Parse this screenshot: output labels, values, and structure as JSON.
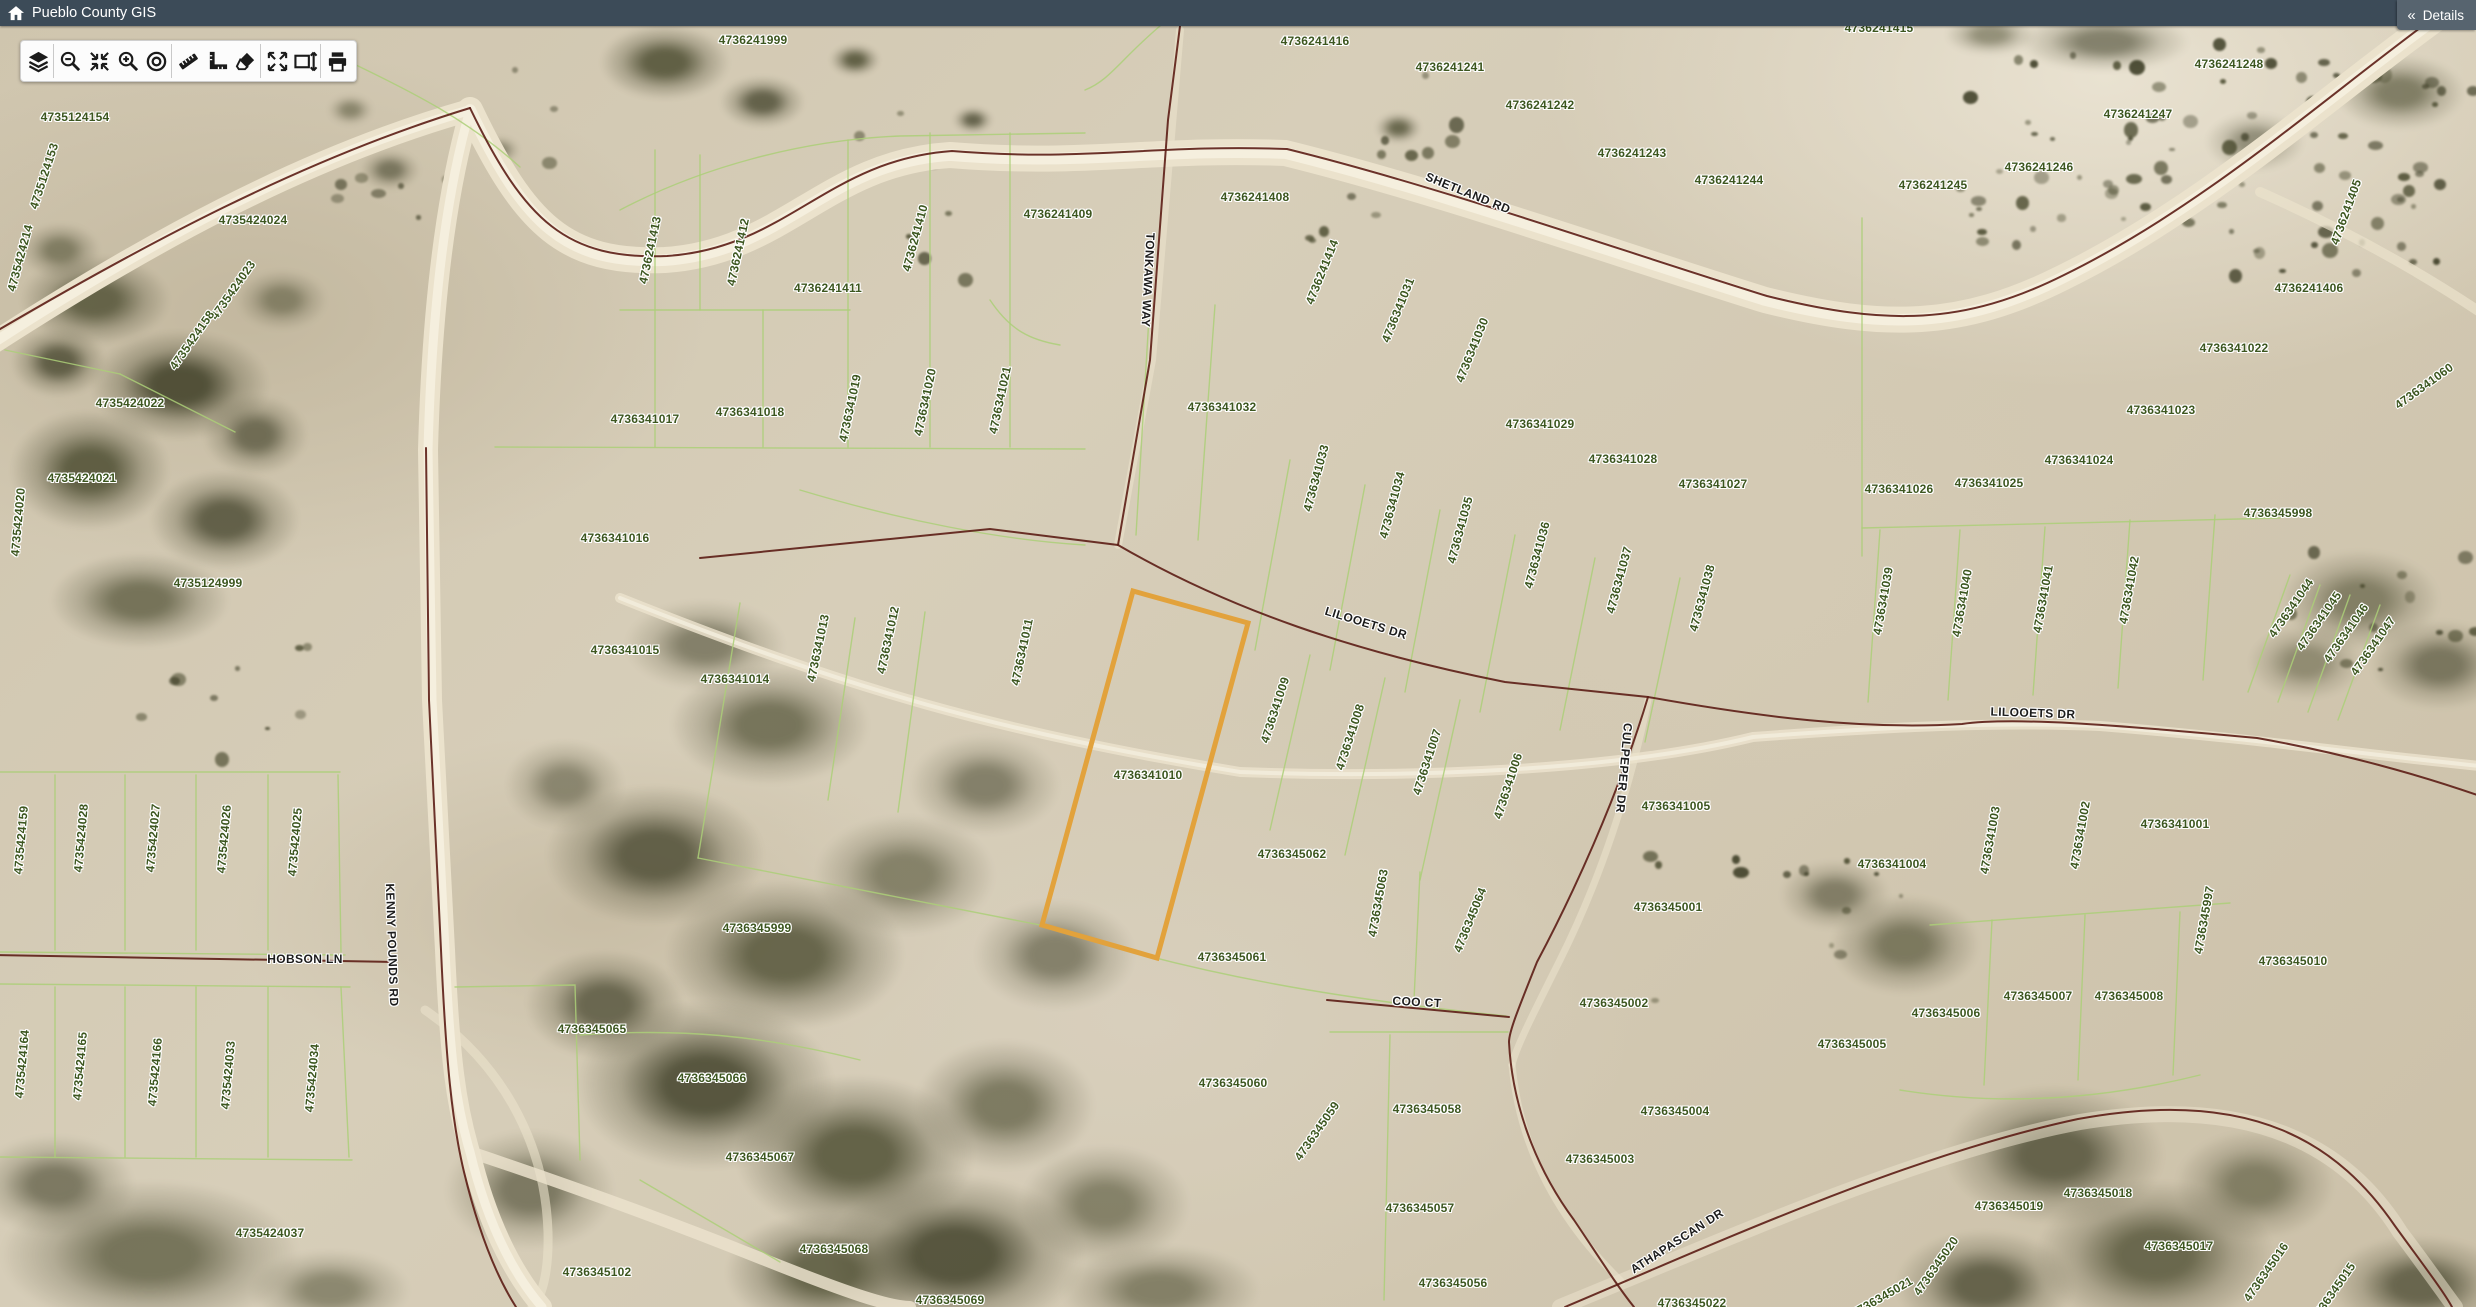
{
  "header": {
    "title": "Pueblo County GIS"
  },
  "details_panel": {
    "label": "Details",
    "collapse_icon": "«"
  },
  "toolbar": {
    "tools": [
      {
        "name": "layers",
        "icon": "layers-icon",
        "group_end": true
      },
      {
        "name": "zoom-out",
        "icon": "zoom-out-icon",
        "group_end": false
      },
      {
        "name": "zoom-to-extent",
        "icon": "zoom-extent-icon",
        "group_end": false
      },
      {
        "name": "zoom-in",
        "icon": "zoom-in-icon",
        "group_end": false
      },
      {
        "name": "locate",
        "icon": "locate-icon",
        "group_end": true
      },
      {
        "name": "measure-distance",
        "icon": "measure-distance-icon",
        "group_end": false
      },
      {
        "name": "measure-area",
        "icon": "measure-area-icon",
        "group_end": false
      },
      {
        "name": "erase",
        "icon": "eraser-icon",
        "group_end": true
      },
      {
        "name": "full-extent",
        "icon": "expand-arrows-icon",
        "group_end": false
      },
      {
        "name": "select-extent",
        "icon": "extent-box-icon",
        "group_end": true
      },
      {
        "name": "print",
        "icon": "printer-icon",
        "group_end": false
      }
    ]
  },
  "map": {
    "colors": {
      "parcel_label": "#3c561f",
      "road_label": "#1c1c1c",
      "parcel_line": "#accf78",
      "boundary_line": "#5c1d15",
      "highlight": "#e2a23c"
    },
    "highlighted_parcel": {
      "parcel_id": "4736341010",
      "outline_color": "#e2a23c",
      "points": "1133,591 1248,623 1157,958 1042,925"
    },
    "parcel_labels": [
      {
        "t": "4735124154",
        "x": 75,
        "y": 117,
        "r": 0
      },
      {
        "t": "4735124153",
        "x": 44,
        "y": 176,
        "r": -72
      },
      {
        "t": "4735424214",
        "x": 20,
        "y": 258,
        "r": -75
      },
      {
        "t": "4735424024",
        "x": 253,
        "y": 220,
        "r": 0
      },
      {
        "t": "4735424023",
        "x": 233,
        "y": 290,
        "r": -55
      },
      {
        "t": "4735424158",
        "x": 192,
        "y": 340,
        "r": -55
      },
      {
        "t": "4735424022",
        "x": 130,
        "y": 403,
        "r": 0
      },
      {
        "t": "4735424021",
        "x": 82,
        "y": 478,
        "r": 0
      },
      {
        "t": "4735424020",
        "x": 18,
        "y": 522,
        "r": -85
      },
      {
        "t": "4735124999",
        "x": 208,
        "y": 583,
        "r": 0
      },
      {
        "t": "4735424159",
        "x": 21,
        "y": 840,
        "r": -85
      },
      {
        "t": "4735424028",
        "x": 81,
        "y": 838,
        "r": -85
      },
      {
        "t": "4735424027",
        "x": 153,
        "y": 838,
        "r": -85
      },
      {
        "t": "4735424026",
        "x": 224,
        "y": 839,
        "r": -85
      },
      {
        "t": "4735424025",
        "x": 295,
        "y": 842,
        "r": -85
      },
      {
        "t": "4735424164",
        "x": 22,
        "y": 1064,
        "r": -85
      },
      {
        "t": "4735424165",
        "x": 80,
        "y": 1066,
        "r": -85
      },
      {
        "t": "4735424166",
        "x": 155,
        "y": 1072,
        "r": -85
      },
      {
        "t": "4735424033",
        "x": 228,
        "y": 1075,
        "r": -85
      },
      {
        "t": "4735424034",
        "x": 312,
        "y": 1078,
        "r": -85
      },
      {
        "t": "4735424037",
        "x": 270,
        "y": 1233,
        "r": 0
      },
      {
        "t": "4736241999",
        "x": 753,
        "y": 40,
        "r": 0
      },
      {
        "t": "4736241400",
        "x": 1065,
        "y": 14,
        "r": 0
      },
      {
        "t": "4736241413",
        "x": 650,
        "y": 250,
        "r": -78
      },
      {
        "t": "4736241412",
        "x": 738,
        "y": 252,
        "r": -78
      },
      {
        "t": "4736241411",
        "x": 828,
        "y": 288,
        "r": 0
      },
      {
        "t": "4736241410",
        "x": 915,
        "y": 238,
        "r": -75
      },
      {
        "t": "4736241409",
        "x": 1058,
        "y": 214,
        "r": 0
      },
      {
        "t": "4736241408",
        "x": 1255,
        "y": 197,
        "r": 0
      },
      {
        "t": "4736241416",
        "x": 1315,
        "y": 41,
        "r": 0
      },
      {
        "t": "4736241241",
        "x": 1450,
        "y": 67,
        "r": 0
      },
      {
        "t": "4736241242",
        "x": 1540,
        "y": 105,
        "r": 0
      },
      {
        "t": "4736241243",
        "x": 1632,
        "y": 153,
        "r": 0
      },
      {
        "t": "4736241244",
        "x": 1729,
        "y": 180,
        "r": 0
      },
      {
        "t": "4736241245",
        "x": 1933,
        "y": 185,
        "r": 0
      },
      {
        "t": "4736241246",
        "x": 2039,
        "y": 167,
        "r": 0
      },
      {
        "t": "4736241247",
        "x": 2138,
        "y": 114,
        "r": 0
      },
      {
        "t": "4736241248",
        "x": 2229,
        "y": 64,
        "r": 0
      },
      {
        "t": "4736241415",
        "x": 1879,
        "y": 28,
        "r": 0
      },
      {
        "t": "4736241414",
        "x": 1322,
        "y": 272,
        "r": -68
      },
      {
        "t": "4736341031",
        "x": 1398,
        "y": 310,
        "r": -68
      },
      {
        "t": "4736341030",
        "x": 1472,
        "y": 350,
        "r": -68
      },
      {
        "t": "4736241405",
        "x": 2346,
        "y": 212,
        "r": -70
      },
      {
        "t": "4736241406",
        "x": 2309,
        "y": 288,
        "r": 0
      },
      {
        "t": "4736341060",
        "x": 2424,
        "y": 386,
        "r": -36
      },
      {
        "t": "4736341022",
        "x": 2234,
        "y": 348,
        "r": 0
      },
      {
        "t": "4736341023",
        "x": 2161,
        "y": 410,
        "r": 0
      },
      {
        "t": "4736341024",
        "x": 2079,
        "y": 460,
        "r": 0
      },
      {
        "t": "4736341025",
        "x": 1989,
        "y": 483,
        "r": 0
      },
      {
        "t": "4736341026",
        "x": 1899,
        "y": 489,
        "r": 0
      },
      {
        "t": "4736345998",
        "x": 2278,
        "y": 513,
        "r": 0
      },
      {
        "t": "4736341017",
        "x": 645,
        "y": 419,
        "r": 0
      },
      {
        "t": "4736341018",
        "x": 750,
        "y": 412,
        "r": 0
      },
      {
        "t": "4736341019",
        "x": 850,
        "y": 408,
        "r": -78
      },
      {
        "t": "4736341020",
        "x": 925,
        "y": 402,
        "r": -78
      },
      {
        "t": "4736341021",
        "x": 1000,
        "y": 400,
        "r": -78
      },
      {
        "t": "4736341032",
        "x": 1222,
        "y": 407,
        "r": 0
      },
      {
        "t": "4736341033",
        "x": 1316,
        "y": 478,
        "r": -75
      },
      {
        "t": "4736341034",
        "x": 1392,
        "y": 505,
        "r": -75
      },
      {
        "t": "4736341035",
        "x": 1460,
        "y": 530,
        "r": -75
      },
      {
        "t": "4736341036",
        "x": 1537,
        "y": 555,
        "r": -75
      },
      {
        "t": "4736341037",
        "x": 1619,
        "y": 580,
        "r": -75
      },
      {
        "t": "4736341038",
        "x": 1702,
        "y": 598,
        "r": -75
      },
      {
        "t": "4736341029",
        "x": 1540,
        "y": 424,
        "r": 0
      },
      {
        "t": "4736341028",
        "x": 1623,
        "y": 459,
        "r": 0
      },
      {
        "t": "4736341027",
        "x": 1713,
        "y": 484,
        "r": 0
      },
      {
        "t": "4736341016",
        "x": 615,
        "y": 538,
        "r": 0
      },
      {
        "t": "4736341015",
        "x": 625,
        "y": 650,
        "r": 0
      },
      {
        "t": "4736341014",
        "x": 735,
        "y": 679,
        "r": 0
      },
      {
        "t": "4736341013",
        "x": 818,
        "y": 648,
        "r": -78
      },
      {
        "t": "4736341012",
        "x": 888,
        "y": 640,
        "r": -78
      },
      {
        "t": "4736341011",
        "x": 1022,
        "y": 652,
        "r": -78
      },
      {
        "t": "4736341010",
        "x": 1148,
        "y": 775,
        "r": 0
      },
      {
        "t": "4736341009",
        "x": 1275,
        "y": 710,
        "r": -72
      },
      {
        "t": "4736341008",
        "x": 1350,
        "y": 737,
        "r": -72
      },
      {
        "t": "4736341007",
        "x": 1427,
        "y": 762,
        "r": -72
      },
      {
        "t": "4736341006",
        "x": 1508,
        "y": 786,
        "r": -72
      },
      {
        "t": "4736341005",
        "x": 1676,
        "y": 806,
        "r": 0
      },
      {
        "t": "4736345062",
        "x": 1292,
        "y": 854,
        "r": 0
      },
      {
        "t": "4736341039",
        "x": 1883,
        "y": 601,
        "r": -80
      },
      {
        "t": "4736341040",
        "x": 1962,
        "y": 603,
        "r": -80
      },
      {
        "t": "4736341041",
        "x": 2043,
        "y": 599,
        "r": -80
      },
      {
        "t": "4736341042",
        "x": 2129,
        "y": 590,
        "r": -80
      },
      {
        "t": "4736341044",
        "x": 2291,
        "y": 608,
        "r": -55
      },
      {
        "t": "4736341045",
        "x": 2319,
        "y": 621,
        "r": -55
      },
      {
        "t": "4736341046",
        "x": 2346,
        "y": 633,
        "r": -55
      },
      {
        "t": "4736341047",
        "x": 2373,
        "y": 646,
        "r": -55
      },
      {
        "t": "4736341001",
        "x": 2175,
        "y": 824,
        "r": 0
      },
      {
        "t": "4736341002",
        "x": 2080,
        "y": 835,
        "r": -80
      },
      {
        "t": "4736341003",
        "x": 1990,
        "y": 840,
        "r": -80
      },
      {
        "t": "4736341004",
        "x": 1892,
        "y": 864,
        "r": 0
      },
      {
        "t": "4736345999",
        "x": 757,
        "y": 928,
        "r": 0
      },
      {
        "t": "4736345065",
        "x": 592,
        "y": 1029,
        "r": 0
      },
      {
        "t": "4736345066",
        "x": 712,
        "y": 1078,
        "r": 0
      },
      {
        "t": "4736345067",
        "x": 760,
        "y": 1157,
        "r": 0
      },
      {
        "t": "4736345068",
        "x": 834,
        "y": 1249,
        "r": 0
      },
      {
        "t": "4736345102",
        "x": 597,
        "y": 1272,
        "r": 0
      },
      {
        "t": "4736345069",
        "x": 950,
        "y": 1300,
        "r": 0
      },
      {
        "t": "4736345061",
        "x": 1232,
        "y": 957,
        "r": 0
      },
      {
        "t": "4736345063",
        "x": 1378,
        "y": 903,
        "r": -80
      },
      {
        "t": "4736345064",
        "x": 1470,
        "y": 920,
        "r": -68
      },
      {
        "t": "4736345060",
        "x": 1233,
        "y": 1083,
        "r": 0
      },
      {
        "t": "4736345059",
        "x": 1317,
        "y": 1131,
        "r": -55
      },
      {
        "t": "4736345058",
        "x": 1427,
        "y": 1109,
        "r": 0
      },
      {
        "t": "4736345057",
        "x": 1420,
        "y": 1208,
        "r": 0
      },
      {
        "t": "4736345056",
        "x": 1453,
        "y": 1283,
        "r": 0
      },
      {
        "t": "4736345001",
        "x": 1668,
        "y": 907,
        "r": 0
      },
      {
        "t": "4736345002",
        "x": 1614,
        "y": 1003,
        "r": 0
      },
      {
        "t": "4736345003",
        "x": 1600,
        "y": 1159,
        "r": 0
      },
      {
        "t": "4736345004",
        "x": 1675,
        "y": 1111,
        "r": 0
      },
      {
        "t": "4736345005",
        "x": 1852,
        "y": 1044,
        "r": 0
      },
      {
        "t": "4736345006",
        "x": 1946,
        "y": 1013,
        "r": 0
      },
      {
        "t": "4736345007",
        "x": 2038,
        "y": 996,
        "r": 0
      },
      {
        "t": "4736345008",
        "x": 2129,
        "y": 996,
        "r": 0
      },
      {
        "t": "4736345997",
        "x": 2204,
        "y": 920,
        "r": -80
      },
      {
        "t": "4736345010",
        "x": 2293,
        "y": 961,
        "r": 0
      },
      {
        "t": "4736345018",
        "x": 2098,
        "y": 1193,
        "r": 0
      },
      {
        "t": "4736345019",
        "x": 2009,
        "y": 1206,
        "r": 0
      },
      {
        "t": "4736345017",
        "x": 2179,
        "y": 1246,
        "r": 0
      },
      {
        "t": "4736345016",
        "x": 2266,
        "y": 1272,
        "r": -55
      },
      {
        "t": "4736345015",
        "x": 2333,
        "y": 1292,
        "r": -55
      },
      {
        "t": "4736345020",
        "x": 1936,
        "y": 1266,
        "r": -55
      },
      {
        "t": "4736345021",
        "x": 1882,
        "y": 1297,
        "r": -30
      },
      {
        "t": "4736345022",
        "x": 1692,
        "y": 1303,
        "r": 0
      }
    ],
    "road_labels": [
      {
        "t": "SHETLAND RD",
        "x": 1468,
        "y": 193,
        "r": 22
      },
      {
        "t": "TONKAWA WAY",
        "x": 1148,
        "y": 280,
        "r": 93
      },
      {
        "t": "LILOOETS DR",
        "x": 1366,
        "y": 623,
        "r": 17
      },
      {
        "t": "LILOOETS DR",
        "x": 2033,
        "y": 713,
        "r": 2
      },
      {
        "t": "KENNY POUNDS RD",
        "x": 392,
        "y": 945,
        "r": 88
      },
      {
        "t": "HOBSON LN",
        "x": 305,
        "y": 959,
        "r": 0
      },
      {
        "t": "COO CT",
        "x": 1417,
        "y": 1002,
        "r": 3
      },
      {
        "t": "CULPEPER DR",
        "x": 1624,
        "y": 768,
        "r": 95
      },
      {
        "t": "ATHAPASCAN DR",
        "x": 1677,
        "y": 1241,
        "r": -33
      }
    ]
  }
}
